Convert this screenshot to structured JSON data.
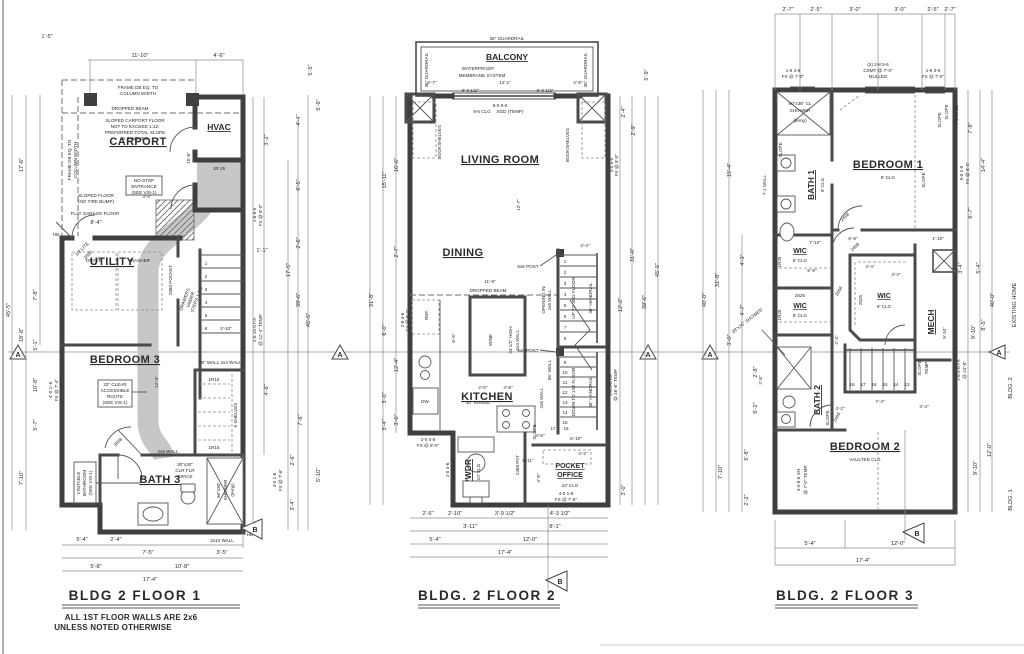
{
  "sheet": {
    "bg": "#ffffff",
    "wall_color": "#3f3f3f",
    "dim_color": "#8d8d8d",
    "shade_color": "#c7c7c7"
  },
  "markers": {
    "a": "A",
    "b": "B"
  },
  "f1": {
    "title": "BLDG 2 FLOOR 1",
    "notes": [
      "ALL 1ST FLOOR WALLS ARE 2x6",
      "UNLESS NOTED OTHERWISE"
    ],
    "rooms": {
      "carport": "CARPORT",
      "hvac": "HVAC",
      "utility": "UTILITY",
      "bedroom3": "BEDROOM 3",
      "bath3": "BATH 3"
    },
    "ann": {
      "frame1": "FRAME DB EQ. TO",
      "frame2": "COLUMN WIDTH",
      "dropped": "DROPPED BEAM",
      "slope": [
        "SLOPED CARPORT FLOOR",
        "NOT TO EXCEED 1:12.",
        "PREFERRED TOTAL SLOPE",
        "IS 4 INCHES."
      ],
      "slfloor": [
        "SLOPED FLOOR",
        "(NO TIRE BUMP)"
      ],
      "flat": "FLAT GARAGE FLOOR",
      "nostep": [
        "NO-STEP",
        "ENTRANCE",
        "(SEE VIS-1)"
      ],
      "r25": "1R 25",
      "pocket": "2880 POCKET",
      "dryer": "DRYER",
      "washer": "WASHER",
      "lite": "1/2 LITE",
      "d2880": "2880",
      "d2868": "2868",
      "drawers": [
        "DRAWERS",
        "UNDER",
        "STEPS 1 & 2"
      ],
      "route": [
        "32\" CLEAR",
        "ACCESSIBLE",
        "ROUTE",
        "(SEE VIS-1)"
      ],
      "visitable": [
        "VISITABLE",
        "BATHROOM",
        "(SEE VIS-1)"
      ],
      "w68": "68\" WALL",
      "w24": "2x4 WALL",
      "r15": "1R15",
      "shelves": "5 SHELVES",
      "w28": "2x8 WALL",
      "w210": "2x10 WALL",
      "clr": [
        "30\"x30\"",
        "CLR FLR",
        "SPACE"
      ],
      "shower": [
        "60\"x30\"",
        "SHOWER",
        "(temp)"
      ],
      "hb": "HB",
      "stairs": [
        "1",
        "2",
        "3",
        "4",
        "5",
        "6"
      ],
      "stairw": "3'-10\"",
      "carlen": "15'-6\"",
      "routelen": "12'-4\"",
      "utilw": "8'-4\"",
      "entry": "3'-6\""
    },
    "dims": {
      "top": [
        "11'-10\"",
        "4'-6\""
      ],
      "left": [
        "1'-5\"",
        "17'-6\"",
        "45'-5\"",
        "18'-8\"",
        "5'-1\"",
        "10'-8\"",
        "5'-7\"",
        "7'-10\"",
        "7'-8\""
      ],
      "leftspec": [
        "4'-0 1'-6",
        "FX @ 7'-4\""
      ],
      "right": [
        "5'-5\"",
        "5'-9\"",
        "4'-4\"",
        "6'-5\"",
        "2'-6\"",
        "1'-1\"",
        "3'-2\"",
        "17'-5\"",
        "39'-6\"",
        "45'-5\"",
        "7'-6\"",
        "2'-6\"",
        "5'-10\"",
        "3'-4\"",
        "4'-6\""
      ],
      "rightspec": [
        "1-6 6-0",
        "FX @ 8'-0\"",
        "2-6 15-0 FX",
        "@ 12'-4\" TEMP",
        "4-0 1-6",
        "FX @ 7'-6\""
      ],
      "bottom": [
        "5'-4\"",
        "2'-4\"",
        "7'-5\"",
        "3'-5\"",
        "5'-8\"",
        "10'-8\"",
        "17'-4\""
      ]
    }
  },
  "f2": {
    "title": "BLDG. 2 FLOOR 2",
    "rooms": {
      "balcony": "BALCONY",
      "living": "LIVING ROOM",
      "dining": "DINING",
      "kitchen": "KITCHEN",
      "pwdr": "PWDR",
      "office1": "POCKET",
      "office2": "OFFICE"
    },
    "ann": {
      "guardrail": "36\" GUARDRAIL",
      "wp": [
        "WATERPROOF",
        "MEMBRANE SYSTEM"
      ],
      "sgd": [
        "8-0 8-0",
        "SGD (TEMP)"
      ],
      "clg86": "8-6 CLG",
      "bookshelves": "BOOKSHELVES",
      "dropped": "DROPPED BEAM",
      "post": "6x6 POST",
      "opening": [
        "OPENING IN",
        "2x6 WALL"
      ],
      "up": "UP TO 3RD FLOOR",
      "down": "DOWN TO 1ST FLOOR",
      "handrail": "36\" HANDRAIL",
      "w36": "36\" WALL",
      "w26": "2x6 WALL",
      "slope": "SLOPE",
      "ref": "REF.",
      "dw": "DW",
      "wine": "WINE",
      "high": [
        "34 1/2\" HIGH",
        "2x4 WALL"
      ],
      "range": "30\" RANGE",
      "clg10": "10' CLG",
      "pkt": "2468 PKT",
      "stairs": [
        "1",
        "2",
        "3",
        "4",
        "5",
        "6",
        "7",
        "8",
        "9",
        "10",
        "11",
        "12",
        "13",
        "14",
        "15",
        "16",
        "17"
      ]
    },
    "dims": {
      "top": [
        "2'-7\"",
        "12'-1\"",
        "2'-8\"",
        "6'-0 1/2\"",
        "6'-0 1/2\""
      ],
      "inner": [
        "12'-7\"",
        "11'-8\"",
        "4'-4\"",
        "6'-6\"",
        "2'-0\"",
        "4'-8\"",
        "5'-10\"",
        "5'-11\"",
        "4'-8\"",
        "4'-2\"",
        "4'-5\"",
        "5'-4\"",
        "3'-4\""
      ],
      "left": [
        "15'-11\"",
        "16'-6\"",
        "31'-8\"",
        "6'-0\"",
        "12'-4\"",
        "3'-0\"",
        "2'-7\"",
        "3'-4\"",
        "3'-0\""
      ],
      "leftspec": [
        "2-6 4-6",
        "FX @ 8'-0\"",
        "2-0 4-6",
        "FX @ 8'-0\"",
        "2-0 4-6",
        "SH @ 8'-0\""
      ],
      "right": [
        "5'-9\"",
        "2'-4\"",
        "2'-9\"",
        "12'-2\"",
        "31'-0\"",
        "39'-6\"",
        "45'-5\"",
        "3'-0\""
      ],
      "rightspec": [
        "4-0 5-0",
        "FX @ 8'-0\"",
        "2-6 5-0 FX",
        "@ 16'-6\" TEMP",
        "4-0 1-6",
        "FX @ 7'-6\""
      ],
      "bottom": [
        "2'-6\"",
        "2'-10\"",
        "3'-9 1/2\"",
        "4'-3 1/2\"",
        "3'-11\"",
        "8'-1\"",
        "5'-4\"",
        "12'-0\"",
        "17'-4\""
      ]
    }
  },
  "f3": {
    "title": "BLDG. 2 FLOOR 3",
    "rooms": {
      "bath1": "BATH 1",
      "bedroom1": "BEDROOM 1",
      "wic": "WIC",
      "mech": "MECH",
      "bath2": "BATH 2",
      "bedroom2": "BEDROOM 2"
    },
    "ann": {
      "clg9": "9' CLG",
      "clg8": "8' CLG",
      "vaulted": "VAULTED CLG",
      "shower": [
        "60\"x36\" CL",
        "SHOWER",
        "(temp)"
      ],
      "shower2": "28\"x36\" SHOWER",
      "slope": "SLOPE",
      "temp": "TEMP",
      "w71": "7-1 WALL",
      "r25": "1R25",
      "d2825": "2825",
      "d2468": "2468",
      "d2668": "2668",
      "existing": "EXISTING HOME",
      "bldg2": "BLDG. 2",
      "bldg1": "BLDG. 1",
      "stairs": [
        "18",
        "17",
        "16",
        "15",
        "14",
        "13"
      ]
    },
    "dims": {
      "top": [
        "2'-7\"",
        "2'-5\"",
        "3'-0\"",
        "3'-0\"",
        "2'-5\"",
        "2'-7\""
      ],
      "topspec": [
        "1-6 3-6",
        "FX @ 7'-0\"",
        "(2) 2-8 5-6",
        "CSMT @ 7'-0\"",
        "MULLED"
      ],
      "left": [
        "15'-4\"",
        "40'-0\"",
        "31'-8\"",
        "4'-3\"",
        "4'-7\"",
        "3'-0\"",
        "2'-8\"",
        "6'-2\"",
        "7'-10\"",
        "5'-8\"",
        "2'-2\""
      ],
      "right": [
        "7'-8\"",
        "14'-4\"",
        "6'-7\"",
        "40'-0\"",
        "8'-5\"",
        "9'-10\"",
        "3'-4\"",
        "5'-4\"",
        "12'-0\"",
        "9'-10\"",
        "12'-0\""
      ],
      "rightspec": [
        "5-0 2-0",
        "FX @ 8'-0\"",
        "1-6 5-0 FX",
        "@ 24'-8\"",
        "3-0 5-6 SH",
        "@ 7'-0\" TEMP"
      ],
      "inner": [
        "6'-8\"",
        "1'-10\"",
        "4'-4\"",
        "4'-4\"",
        "2'-4\"",
        "7'-4\"",
        "2'-8\"",
        "5'-8\"",
        "7'-10\"",
        "4'-2\"",
        "3'-4\"",
        "9'-10\""
      ],
      "bottom": [
        "5'-4\"",
        "12'-0\"",
        "17'-4\""
      ]
    }
  }
}
